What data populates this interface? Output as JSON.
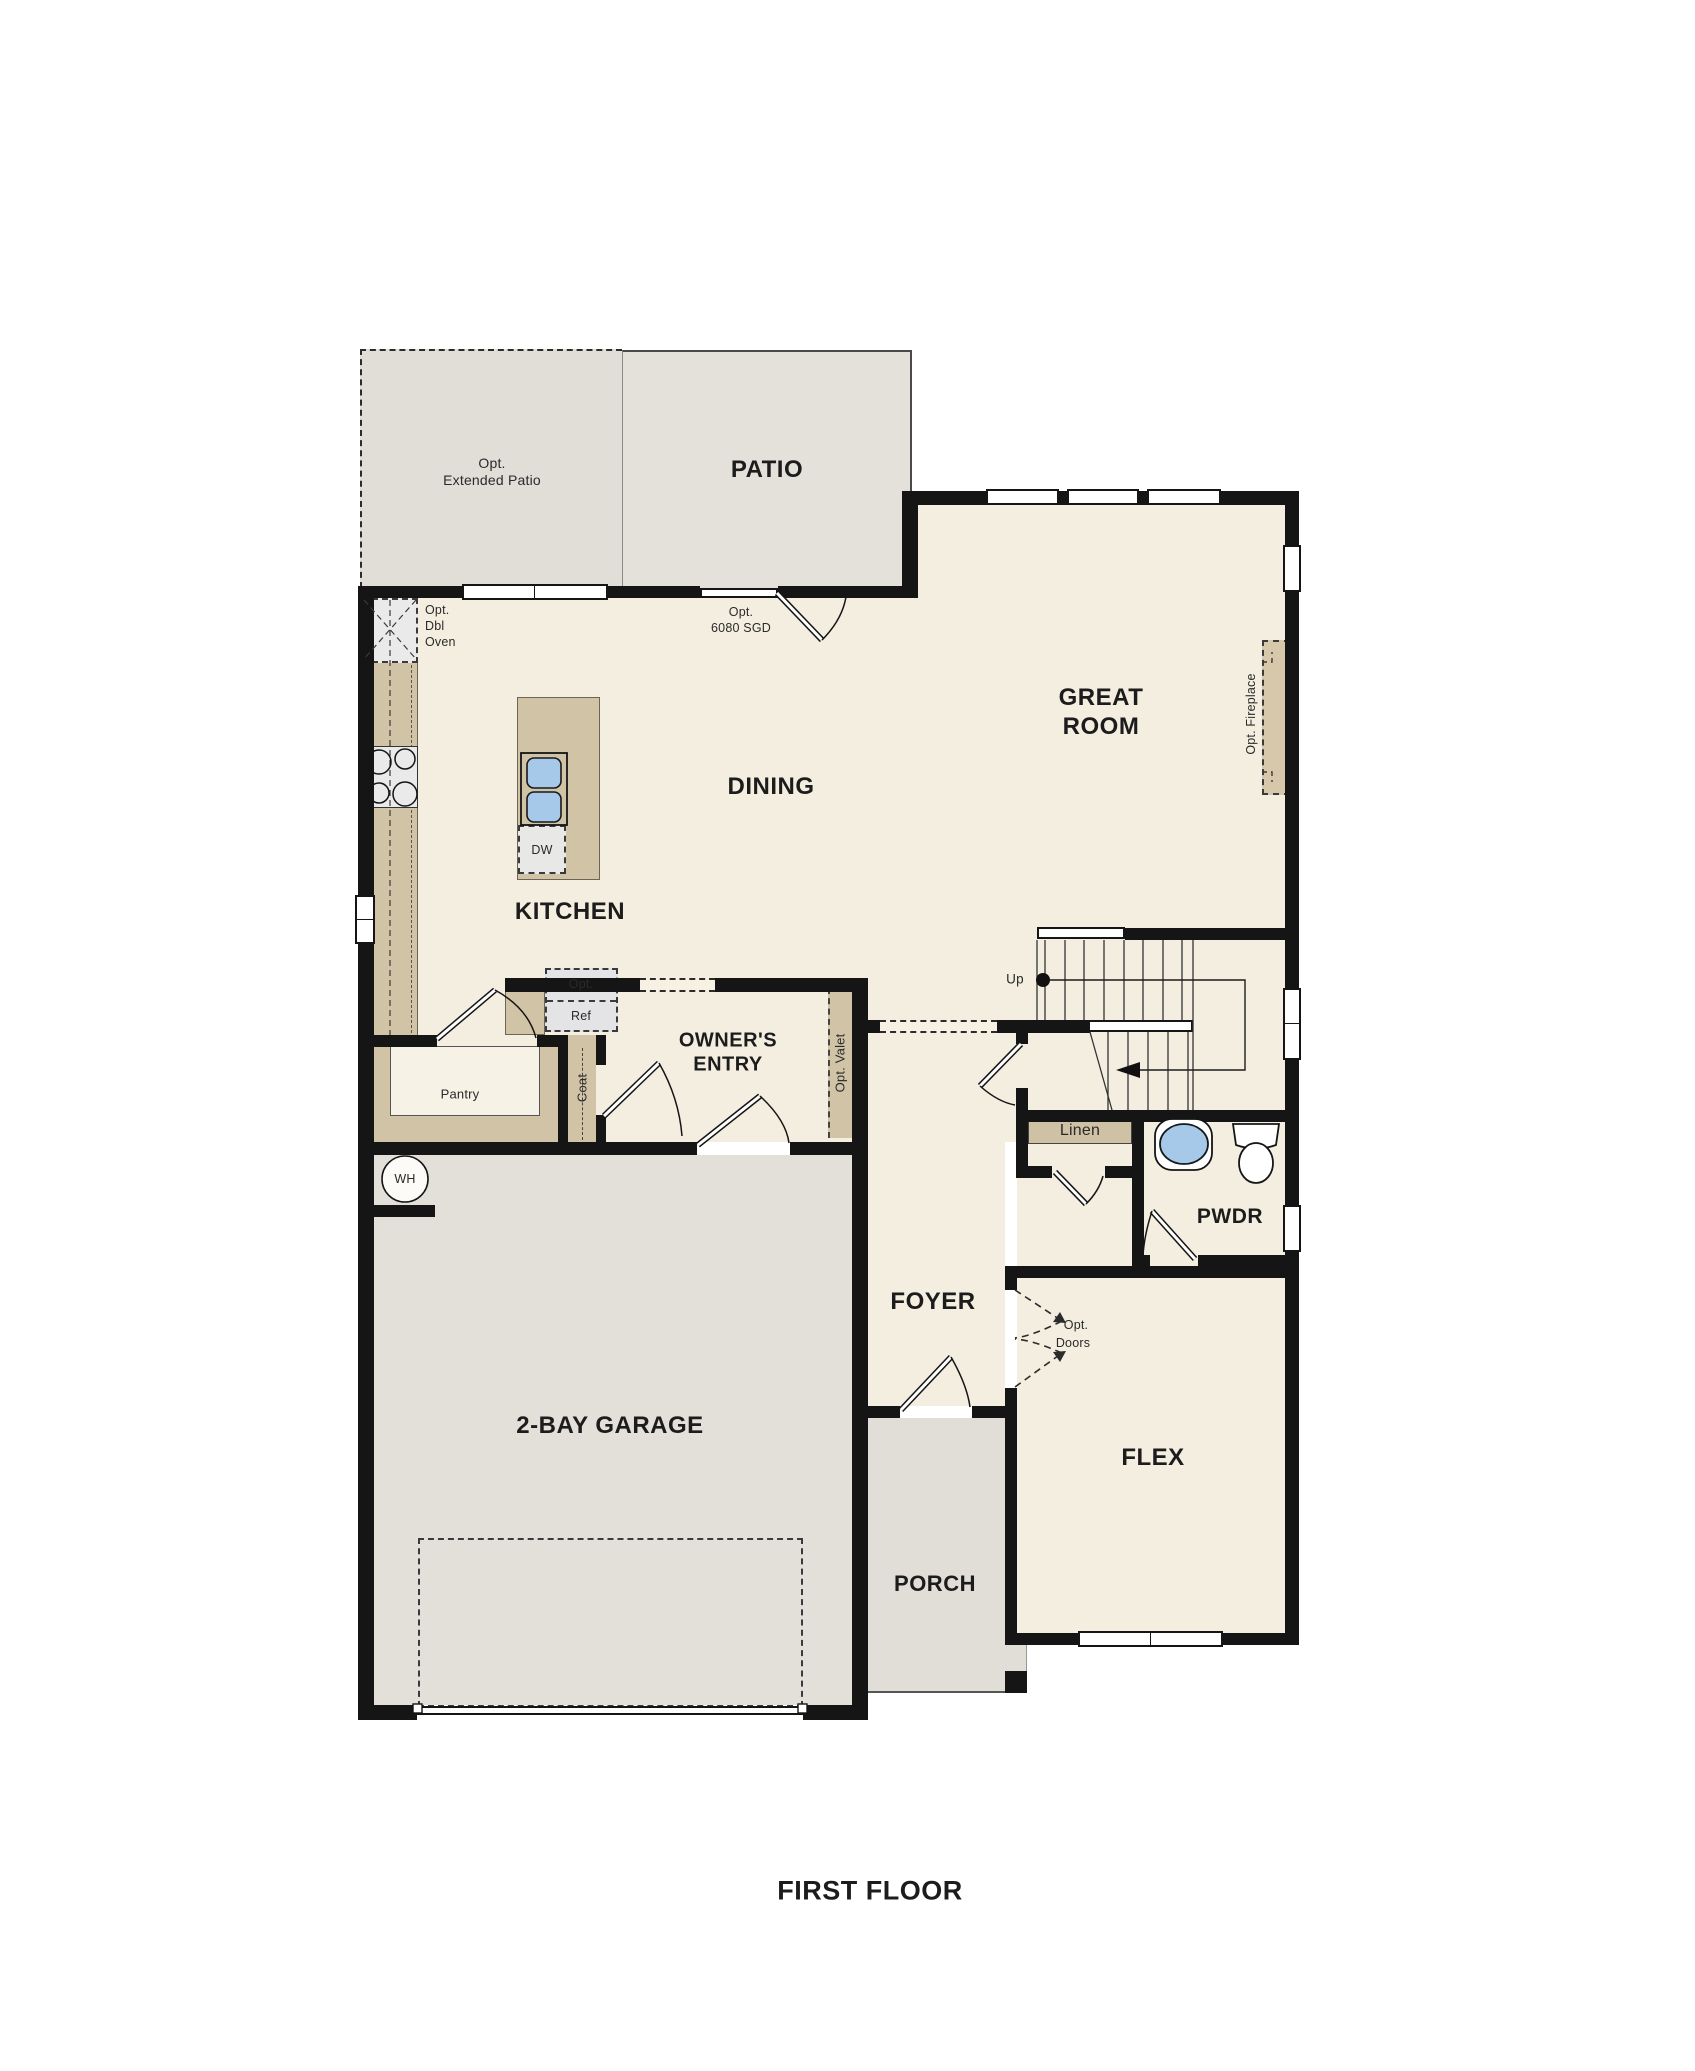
{
  "title": "FIRST FLOOR",
  "rooms": {
    "patio": "PATIO",
    "ext_patio_1": "Opt.",
    "ext_patio_2": "Extended Patio",
    "great_1": "GREAT",
    "great_2": "ROOM",
    "dining": "DINING",
    "kitchen": "KITCHEN",
    "owners_1": "OWNER'S",
    "owners_2": "ENTRY",
    "pantry": "Pantry",
    "coat": "Coat",
    "valet": "Opt. Valet",
    "linen": "Linen",
    "pwdr": "PWDR",
    "foyer": "FOYER",
    "flex": "FLEX",
    "garage": "2-BAY GARAGE",
    "porch": "PORCH"
  },
  "annotations": {
    "dbl_oven_1": "Opt.",
    "dbl_oven_2": "Dbl",
    "dbl_oven_3": "Oven",
    "ref_1": "Opt.",
    "ref_2": "Ref",
    "sgd_1": "Opt.",
    "sgd_2": "6080 SGD",
    "doors_1": "Opt.",
    "doors_2": "Doors",
    "fireplace": "Opt. Fireplace",
    "dw": "DW",
    "wh": "WH",
    "up": "Up"
  },
  "colors": {
    "wall": "#151515",
    "floor": "#f4eee0",
    "concrete": "#e3e0da",
    "casework": "#d1c3a6",
    "fixture_blue": "#a6c9e9",
    "appliance": "#e9e9e9"
  }
}
